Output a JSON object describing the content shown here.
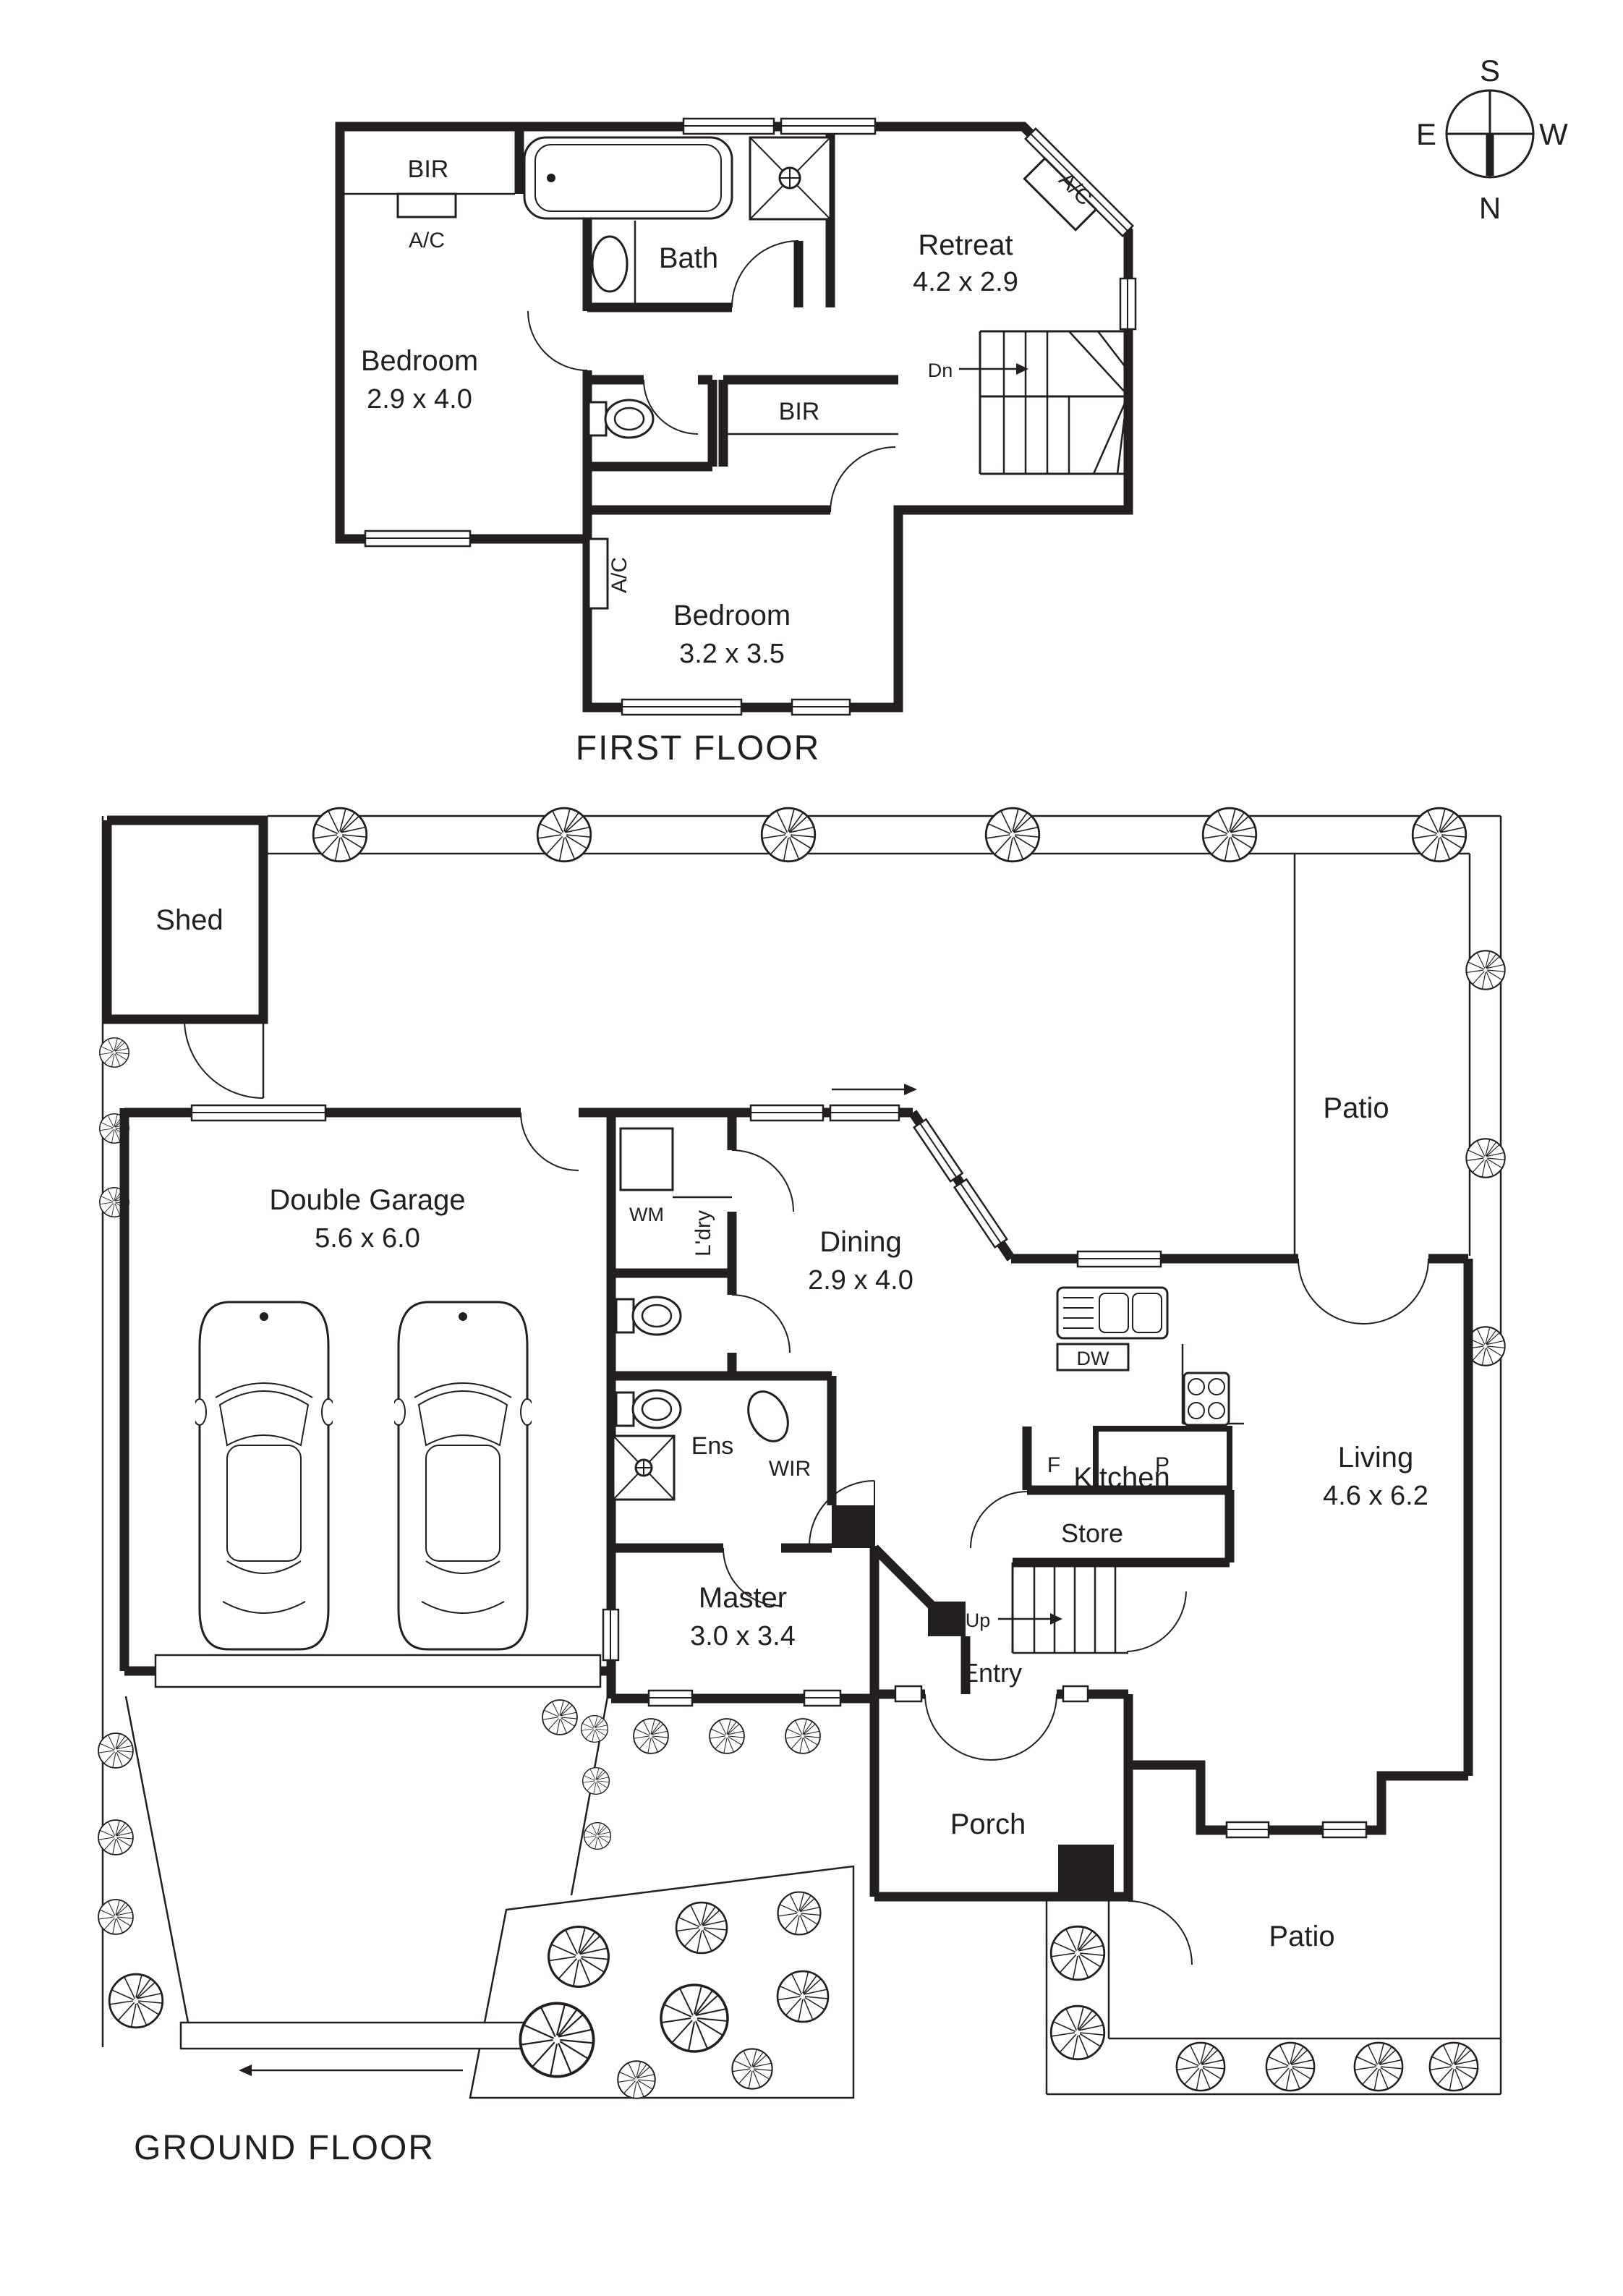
{
  "compass": {
    "s": "S",
    "e": "E",
    "w": "W",
    "n": "N"
  },
  "first": {
    "title": "FIRST FLOOR",
    "bir1": "BIR",
    "ac1": "A/C",
    "bedroom1_name": "Bedroom",
    "bedroom1_dims": "2.9 x 4.0",
    "bath": "Bath",
    "retreat_name": "Retreat",
    "retreat_dims": "4.2 x 2.9",
    "ac_diag": "A/C",
    "dn": "Dn",
    "bir2": "BIR",
    "ac2": "A/C",
    "bedroom2_name": "Bedroom",
    "bedroom2_dims": "3.2 x 3.5"
  },
  "ground": {
    "title": "GROUND FLOOR",
    "shed": "Shed",
    "patio_top": "Patio",
    "patio_bottom": "Patio",
    "garage_name": "Double Garage",
    "garage_dims": "5.6 x 6.0",
    "wm": "WM",
    "ldry": "L'dry",
    "dining_name": "Dining",
    "dining_dims": "2.9 x 4.0",
    "dw": "DW",
    "kitchen": "Kitchen",
    "living_name": "Living",
    "living_dims": "4.6 x 6.2",
    "ens": "Ens",
    "wir": "WIR",
    "f": "F",
    "p": "P",
    "store": "Store",
    "up": "Up",
    "entry": "Entry",
    "porch": "Porch",
    "master_name": "Master",
    "master_dims": "3.0 x 3.4"
  }
}
